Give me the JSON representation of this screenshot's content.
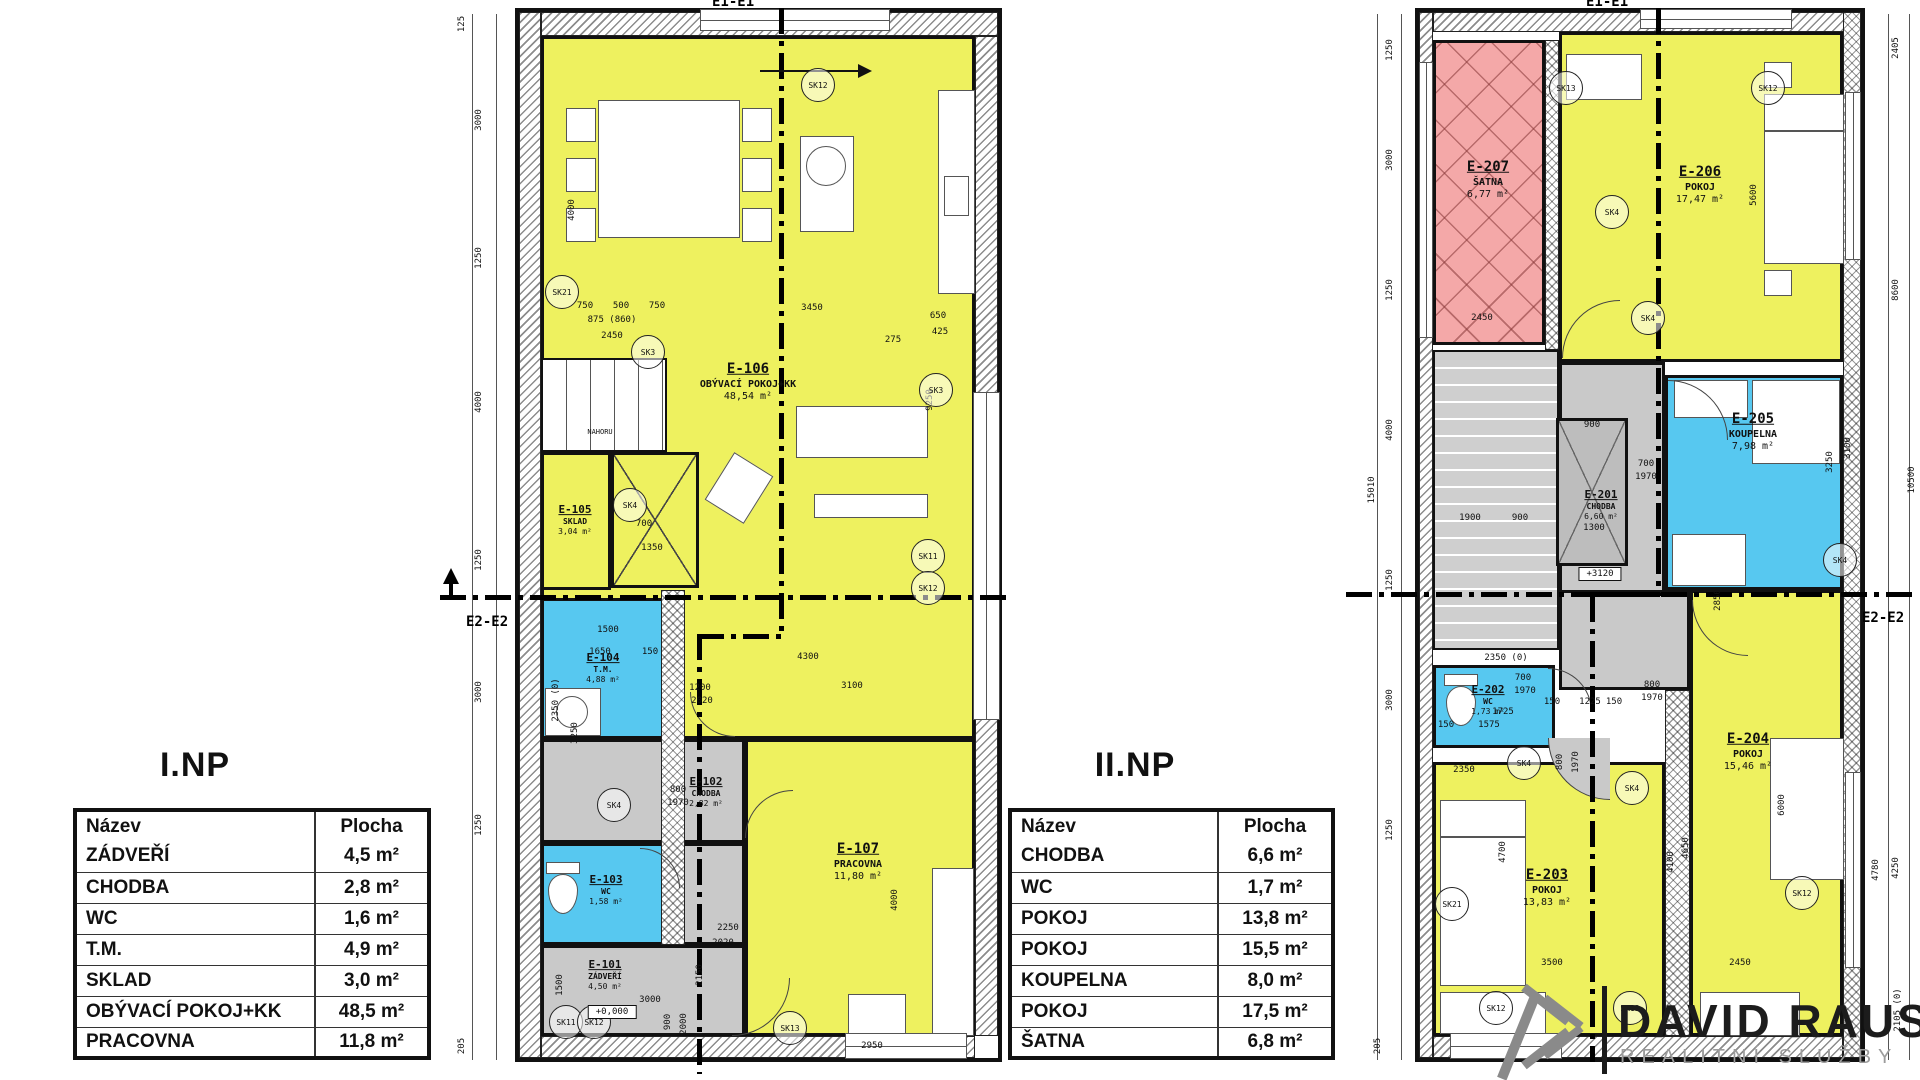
{
  "logo": {
    "name": "DAVID RAUS",
    "tagline": "REALITNÍ SLUŽBY"
  },
  "colors": {
    "room_yellow": "#eef15f",
    "room_blue": "#57c8f0",
    "room_pink": "#f4a8a8",
    "room_gray": "#c9c9c9",
    "wall": "#111111",
    "logo_dark": "#1c1c1c",
    "logo_gray": "#9c9c9c"
  },
  "floor1": {
    "title": "I.NP",
    "section_top": "E1-E1",
    "section_side": "E2-E2",
    "stairs_label": "NAHORU",
    "level": "+0,000",
    "table": {
      "headers": {
        "name": "Název",
        "area": "Plocha"
      },
      "rows": [
        {
          "name": "ZÁDVEŘÍ",
          "area": "4,5 m²"
        },
        {
          "name": "CHODBA",
          "area": "2,8 m²"
        },
        {
          "name": "WC",
          "area": "1,6 m²"
        },
        {
          "name": "T.M.",
          "area": "4,9 m²"
        },
        {
          "name": "SKLAD",
          "area": "3,0 m²"
        },
        {
          "name": "OBÝVACÍ POKOJ+KK",
          "area": "48,5 m²"
        },
        {
          "name": "PRACOVNA",
          "area": "11,8 m²"
        }
      ]
    },
    "rooms": {
      "e101": {
        "id": "E-101",
        "name": "ZÁDVEŘÍ",
        "area": "4,50 m²"
      },
      "e102": {
        "id": "E-102",
        "name": "CHODBA",
        "area": "2,82 m²"
      },
      "e103": {
        "id": "E-103",
        "name": "WC",
        "area": "1,58 m²"
      },
      "e104": {
        "id": "E-104",
        "name": "T.M.",
        "area": "4,88 m²"
      },
      "e105": {
        "id": "E-105",
        "name": "SKLAD",
        "area": "3,04 m²"
      },
      "e106": {
        "id": "E-106",
        "name": "OBÝVACÍ POKOJ+KK",
        "area": "48,54 m²"
      },
      "e107": {
        "id": "E-107",
        "name": "PRACOVNA",
        "area": "11,80 m²"
      }
    },
    "dims": [
      {
        "t": "125",
        "x": 462,
        "y": 24,
        "v": 1
      },
      {
        "t": "3000",
        "x": 479,
        "y": 120,
        "v": 1
      },
      {
        "t": "1250",
        "x": 479,
        "y": 258,
        "v": 1
      },
      {
        "t": "4000",
        "x": 479,
        "y": 402,
        "v": 1
      },
      {
        "t": "1250",
        "x": 479,
        "y": 560,
        "v": 1
      },
      {
        "t": "3000",
        "x": 479,
        "y": 692,
        "v": 1
      },
      {
        "t": "1250",
        "x": 479,
        "y": 825,
        "v": 1
      },
      {
        "t": "205",
        "x": 462,
        "y": 1046,
        "v": 1
      },
      {
        "t": "4000",
        "x": 572,
        "y": 210,
        "v": 1
      },
      {
        "t": "9250",
        "x": 930,
        "y": 400,
        "v": 1
      },
      {
        "t": "750",
        "x": 585,
        "y": 306
      },
      {
        "t": "500",
        "x": 621,
        "y": 306
      },
      {
        "t": "750",
        "x": 657,
        "y": 306
      },
      {
        "t": "875 (860)",
        "x": 612,
        "y": 320
      },
      {
        "t": "2450",
        "x": 612,
        "y": 336
      },
      {
        "t": "3450",
        "x": 812,
        "y": 308
      },
      {
        "t": "650",
        "x": 938,
        "y": 316
      },
      {
        "t": "425",
        "x": 940,
        "y": 332
      },
      {
        "t": "275",
        "x": 893,
        "y": 340
      },
      {
        "t": "700",
        "x": 644,
        "y": 524
      },
      {
        "t": "1350",
        "x": 652,
        "y": 548
      },
      {
        "t": "1500",
        "x": 608,
        "y": 630
      },
      {
        "t": "1650",
        "x": 600,
        "y": 652
      },
      {
        "t": "150",
        "x": 650,
        "y": 652
      },
      {
        "t": "2350 (0)",
        "x": 556,
        "y": 700,
        "v": 1
      },
      {
        "t": "3250",
        "x": 575,
        "y": 733,
        "v": 1
      },
      {
        "t": "4300",
        "x": 808,
        "y": 657
      },
      {
        "t": "3100",
        "x": 852,
        "y": 686
      },
      {
        "t": "1200",
        "x": 700,
        "y": 688
      },
      {
        "t": "2020",
        "x": 702,
        "y": 701
      },
      {
        "t": "800",
        "x": 678,
        "y": 790
      },
      {
        "t": "1970",
        "x": 678,
        "y": 803
      },
      {
        "t": "2250",
        "x": 728,
        "y": 928
      },
      {
        "t": "2020",
        "x": 723,
        "y": 943
      },
      {
        "t": "3000",
        "x": 650,
        "y": 1000
      },
      {
        "t": "900",
        "x": 668,
        "y": 1022,
        "v": 1
      },
      {
        "t": "2000",
        "x": 684,
        "y": 1024,
        "v": 1
      },
      {
        "t": "2950",
        "x": 872,
        "y": 1046
      },
      {
        "t": "4000",
        "x": 895,
        "y": 900,
        "v": 1
      },
      {
        "t": "2150",
        "x": 700,
        "y": 975,
        "v": 1
      },
      {
        "t": "1500",
        "x": 560,
        "y": 985,
        "v": 1
      }
    ],
    "sk": [
      {
        "t": "SK12",
        "x": 818,
        "y": 85
      },
      {
        "t": "SK21",
        "x": 562,
        "y": 292
      },
      {
        "t": "SK3",
        "x": 648,
        "y": 352
      },
      {
        "t": "SK3",
        "x": 936,
        "y": 390
      },
      {
        "t": "SK4",
        "x": 630,
        "y": 505
      },
      {
        "t": "SK4",
        "x": 614,
        "y": 805
      },
      {
        "t": "SK11",
        "x": 928,
        "y": 556
      },
      {
        "t": "SK12",
        "x": 928,
        "y": 588
      },
      {
        "t": "SK11",
        "x": 566,
        "y": 1022
      },
      {
        "t": "SK12",
        "x": 594,
        "y": 1022
      },
      {
        "t": "SK13",
        "x": 790,
        "y": 1028
      }
    ]
  },
  "floor2": {
    "title": "II.NP",
    "section_top": "E1-E1",
    "section_side": "E2-E2",
    "level": "+3120",
    "table": {
      "headers": {
        "name": "Název",
        "area": "Plocha"
      },
      "rows": [
        {
          "name": "CHODBA",
          "area": "6,6 m²"
        },
        {
          "name": "WC",
          "area": "1,7 m²"
        },
        {
          "name": "POKOJ",
          "area": "13,8 m²"
        },
        {
          "name": "POKOJ",
          "area": "15,5 m²"
        },
        {
          "name": "KOUPELNA",
          "area": "8,0 m²"
        },
        {
          "name": "POKOJ",
          "area": "17,5 m²"
        },
        {
          "name": "ŠATNA",
          "area": "6,8 m²"
        }
      ]
    },
    "rooms": {
      "e201": {
        "id": "E-201",
        "name": "CHODBA",
        "area": "6,60 m²"
      },
      "e202": {
        "id": "E-202",
        "name": "WC",
        "area": "1,73 m²"
      },
      "e203": {
        "id": "E-203",
        "name": "POKOJ",
        "area": "13,83 m²"
      },
      "e204": {
        "id": "E-204",
        "name": "POKOJ",
        "area": "15,46 m²"
      },
      "e205": {
        "id": "E-205",
        "name": "KOUPELNA",
        "area": "7,98 m²"
      },
      "e206": {
        "id": "E-206",
        "name": "POKOJ",
        "area": "17,47 m²"
      },
      "e207": {
        "id": "E-207",
        "name": "ŠATNA",
        "area": "6,77 m²"
      }
    },
    "dims": [
      {
        "t": "1250",
        "x": 1390,
        "y": 50,
        "v": 1
      },
      {
        "t": "3000",
        "x": 1390,
        "y": 160,
        "v": 1
      },
      {
        "t": "1250",
        "x": 1390,
        "y": 290,
        "v": 1
      },
      {
        "t": "15010",
        "x": 1372,
        "y": 490,
        "v": 1
      },
      {
        "t": "4000",
        "x": 1390,
        "y": 430,
        "v": 1
      },
      {
        "t": "1250",
        "x": 1390,
        "y": 580,
        "v": 1
      },
      {
        "t": "3000",
        "x": 1390,
        "y": 700,
        "v": 1
      },
      {
        "t": "1250",
        "x": 1390,
        "y": 830,
        "v": 1
      },
      {
        "t": "205",
        "x": 1378,
        "y": 1046,
        "v": 1
      },
      {
        "t": "2405",
        "x": 1896,
        "y": 48,
        "v": 1
      },
      {
        "t": "8600",
        "x": 1896,
        "y": 290,
        "v": 1
      },
      {
        "t": "10500",
        "x": 1912,
        "y": 480,
        "v": 1
      },
      {
        "t": "4780",
        "x": 1876,
        "y": 870,
        "v": 1
      },
      {
        "t": "4250",
        "x": 1896,
        "y": 868,
        "v": 1
      },
      {
        "t": "2105 (0)",
        "x": 1898,
        "y": 1010,
        "v": 1
      },
      {
        "t": "2450",
        "x": 1482,
        "y": 318
      },
      {
        "t": "5600",
        "x": 1754,
        "y": 195,
        "v": 1
      },
      {
        "t": "1900",
        "x": 1470,
        "y": 518
      },
      {
        "t": "900",
        "x": 1520,
        "y": 518
      },
      {
        "t": "1300",
        "x": 1594,
        "y": 528
      },
      {
        "t": "700",
        "x": 1646,
        "y": 464
      },
      {
        "t": "1970",
        "x": 1646,
        "y": 477
      },
      {
        "t": "3250",
        "x": 1830,
        "y": 462,
        "v": 1
      },
      {
        "t": "3100",
        "x": 1848,
        "y": 448,
        "v": 1
      },
      {
        "t": "800",
        "x": 1652,
        "y": 685
      },
      {
        "t": "1970",
        "x": 1652,
        "y": 698
      },
      {
        "t": "2350 (0)",
        "x": 1506,
        "y": 658
      },
      {
        "t": "700",
        "x": 1523,
        "y": 678
      },
      {
        "t": "1970",
        "x": 1525,
        "y": 691
      },
      {
        "t": "1725",
        "x": 1503,
        "y": 712
      },
      {
        "t": "150",
        "x": 1446,
        "y": 725
      },
      {
        "t": "1575",
        "x": 1489,
        "y": 725
      },
      {
        "t": "150",
        "x": 1552,
        "y": 702
      },
      {
        "t": "1225",
        "x": 1590,
        "y": 702
      },
      {
        "t": "150",
        "x": 1614,
        "y": 702
      },
      {
        "t": "4650",
        "x": 1686,
        "y": 848,
        "v": 1
      },
      {
        "t": "4100",
        "x": 1671,
        "y": 862,
        "v": 1
      },
      {
        "t": "6000",
        "x": 1782,
        "y": 805,
        "v": 1
      },
      {
        "t": "4700",
        "x": 1503,
        "y": 852,
        "v": 1
      },
      {
        "t": "3500",
        "x": 1552,
        "y": 963
      },
      {
        "t": "2450",
        "x": 1740,
        "y": 963
      },
      {
        "t": "2350",
        "x": 1464,
        "y": 770
      },
      {
        "t": "2850",
        "x": 1718,
        "y": 600,
        "v": 1
      },
      {
        "t": "800",
        "x": 1560,
        "y": 762,
        "v": 1
      },
      {
        "t": "1970",
        "x": 1576,
        "y": 762,
        "v": 1
      },
      {
        "t": "900",
        "x": 1592,
        "y": 425
      }
    ],
    "sk": [
      {
        "t": "SK13",
        "x": 1566,
        "y": 88
      },
      {
        "t": "SK12",
        "x": 1768,
        "y": 88
      },
      {
        "t": "SK4",
        "x": 1612,
        "y": 212
      },
      {
        "t": "SK4",
        "x": 1648,
        "y": 318
      },
      {
        "t": "SK4",
        "x": 1840,
        "y": 560
      },
      {
        "t": "SK4",
        "x": 1524,
        "y": 763
      },
      {
        "t": "SK4",
        "x": 1632,
        "y": 788
      },
      {
        "t": "SK12",
        "x": 1802,
        "y": 893
      },
      {
        "t": "SK21",
        "x": 1452,
        "y": 904
      },
      {
        "t": "SK12",
        "x": 1496,
        "y": 1008
      },
      {
        "t": "SK13",
        "x": 1630,
        "y": 1008
      }
    ]
  }
}
